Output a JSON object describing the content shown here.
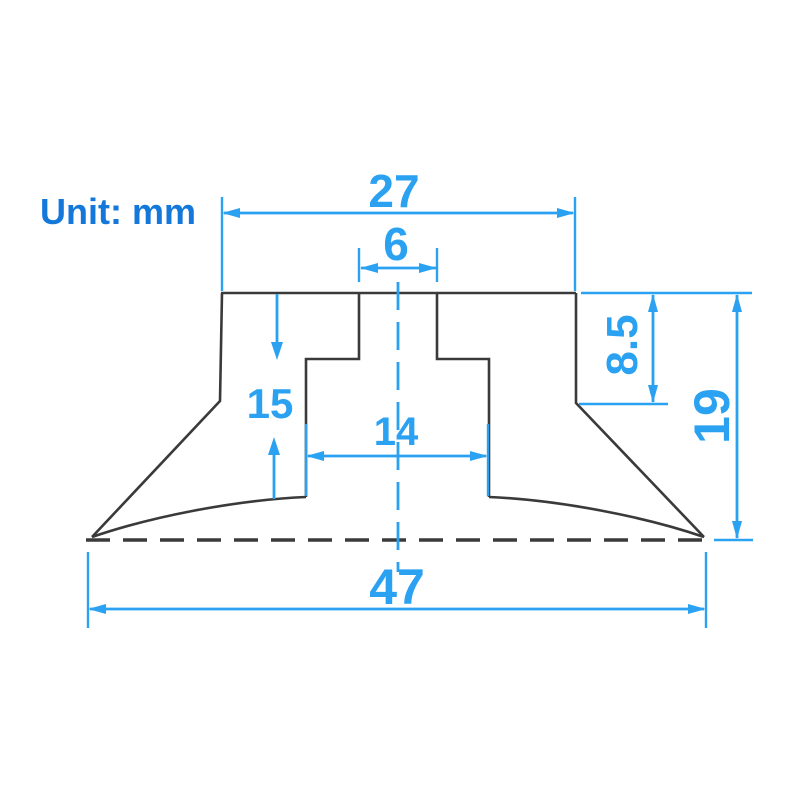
{
  "drawing": {
    "unit_label": "Unit: mm",
    "dimensions": {
      "cap_width": {
        "value": "27"
      },
      "slot_width": {
        "value": "6"
      },
      "neck_height": {
        "value": "8.5"
      },
      "overall_height": {
        "value": "19"
      },
      "cup_height": {
        "value": "15"
      },
      "recess_width": {
        "value": "14"
      },
      "base_width": {
        "value": "47"
      }
    },
    "colors": {
      "dimension_blue": "#2aa1f1",
      "unit_label_blue": "#1478db",
      "outline_dark": "#3a3a3a",
      "background": "#ffffff"
    }
  }
}
